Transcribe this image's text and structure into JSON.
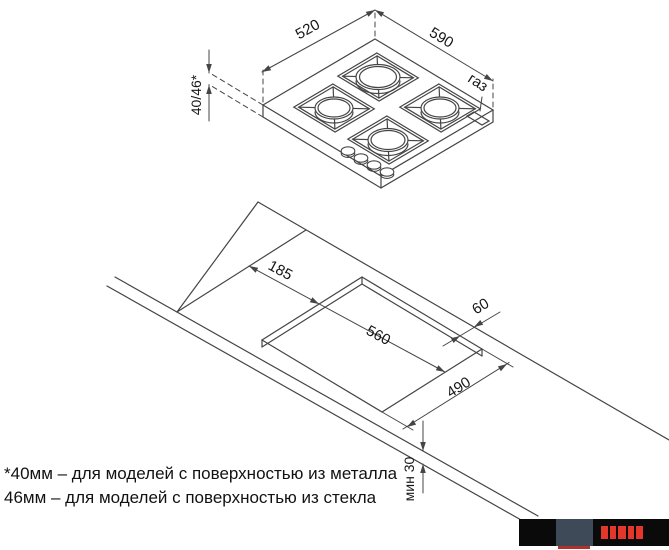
{
  "colors": {
    "line": "#454545",
    "text": "#161616",
    "logo_black": "#0a0a0a",
    "logo_slate": "#3f4a59",
    "logo_red": "#e4372b"
  },
  "hob_view": {
    "width": "520",
    "length": "590",
    "height": "40/46*",
    "gas": "газ"
  },
  "installation_view": {
    "side_offset": "185",
    "cutout_length": "560",
    "rear_clearance": "60",
    "cutout_width": "490",
    "worktop_thickness": "мин 30"
  },
  "footnotes": {
    "metal": "*40мм – для моделей с поверхностью из металла",
    "glass": "46мм – для моделей с поверхностью из стекла"
  }
}
